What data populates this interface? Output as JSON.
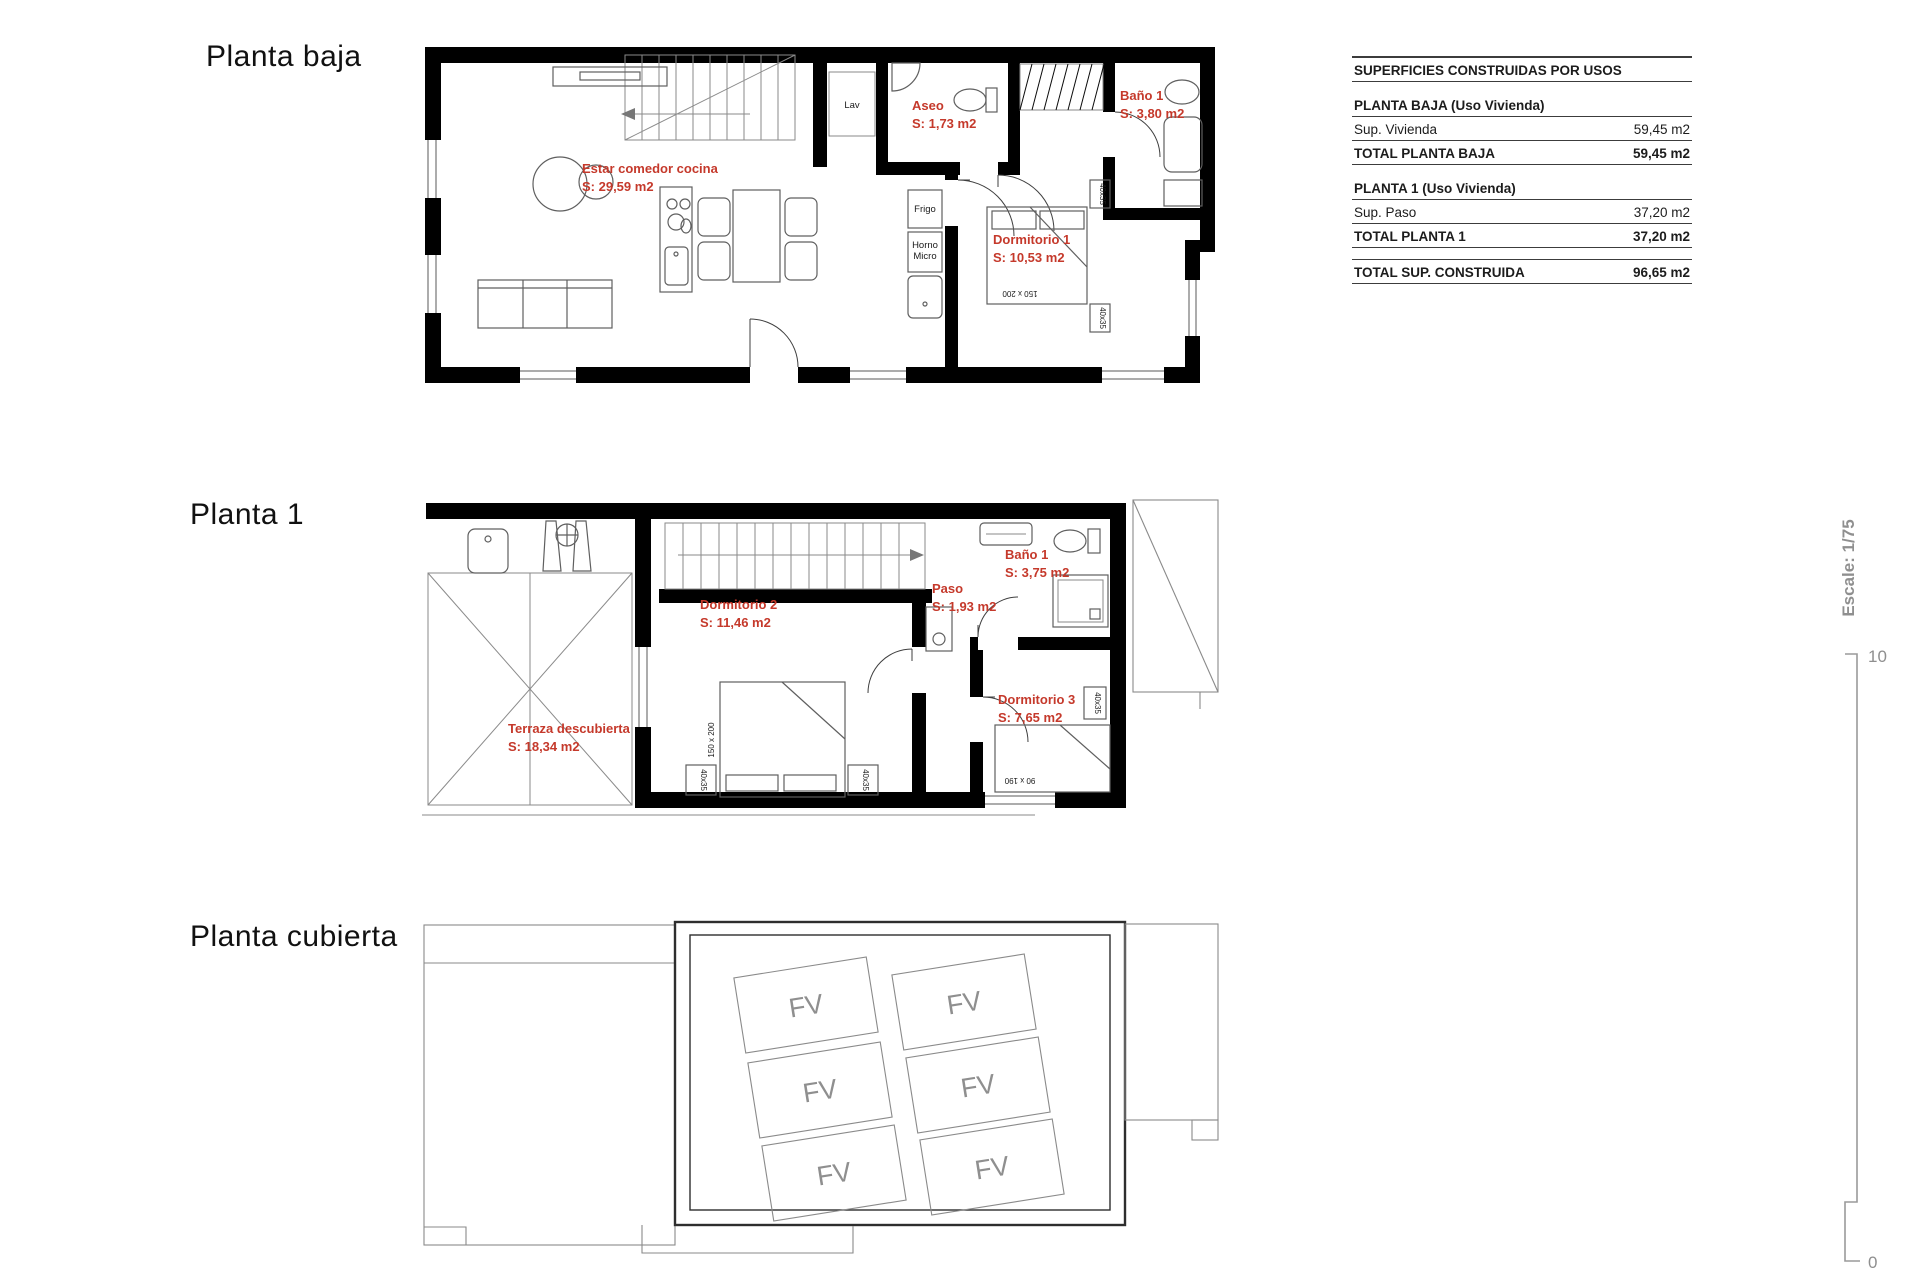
{
  "titles": {
    "floor1": "Planta baja",
    "floor2": "Planta 1",
    "floor3": "Planta cubierta"
  },
  "areas_table": {
    "header": "SUPERFICIES CONSTRUIDAS POR USOS",
    "sections": [
      {
        "title": "PLANTA BAJA (Uso Vivienda)",
        "rows": [
          {
            "label": "Sup. Vivienda",
            "value": "59,45 m2"
          },
          {
            "label": "TOTAL PLANTA BAJA",
            "value": "59,45 m2"
          }
        ]
      },
      {
        "title": "PLANTA 1 (Uso Vivienda)",
        "rows": [
          {
            "label": "Sup. Paso",
            "value": "37,20 m2"
          },
          {
            "label": "TOTAL PLANTA 1",
            "value": "37,20 m2"
          }
        ]
      }
    ],
    "total": {
      "label": "TOTAL SUP. CONSTRUIDA",
      "value": "96,65 m2"
    }
  },
  "planta_baja": {
    "rooms": {
      "estar": {
        "name": "Estar comedor cocina",
        "area": "S: 29,59 m2"
      },
      "aseo": {
        "name": "Aseo",
        "area": "S: 1,73 m2"
      },
      "bano1": {
        "name": "Baño 1",
        "area": "S: 3,80 m2"
      },
      "dormitorio1": {
        "name": "Dormitorio 1",
        "area": "S: 10,53 m2"
      }
    },
    "labels": {
      "lav": "Lav",
      "frigo": "Frigo",
      "horno": "Horno",
      "micro": "Micro",
      "bed_double": "150 x 200",
      "nightstand": "40x35"
    }
  },
  "planta_1": {
    "rooms": {
      "terraza": {
        "name": "Terraza descubierta",
        "area": "S: 18,34 m2"
      },
      "dormitorio2": {
        "name": "Dormitorio 2",
        "area": "S: 11,46 m2"
      },
      "paso": {
        "name": "Paso",
        "area": "S: 1,93 m2"
      },
      "bano1": {
        "name": "Baño 1",
        "area": "S: 3,75 m2"
      },
      "dormitorio3": {
        "name": "Dormitorio 3",
        "area": "S: 7,65 m2"
      }
    },
    "labels": {
      "bed_double": "150 x 200",
      "bed_single": "90 x 190",
      "nightstand": "40x35"
    }
  },
  "planta_cubierta": {
    "panel_label": "FV",
    "panel_count": 6
  },
  "scale": {
    "text": "Escale: 1/75",
    "top": "10",
    "bottom": "0"
  },
  "colors": {
    "label_red": "#c5392b",
    "wall_black": "#000000",
    "line_gray": "#5f5f5f",
    "muted_gray": "#8f8f8f"
  }
}
